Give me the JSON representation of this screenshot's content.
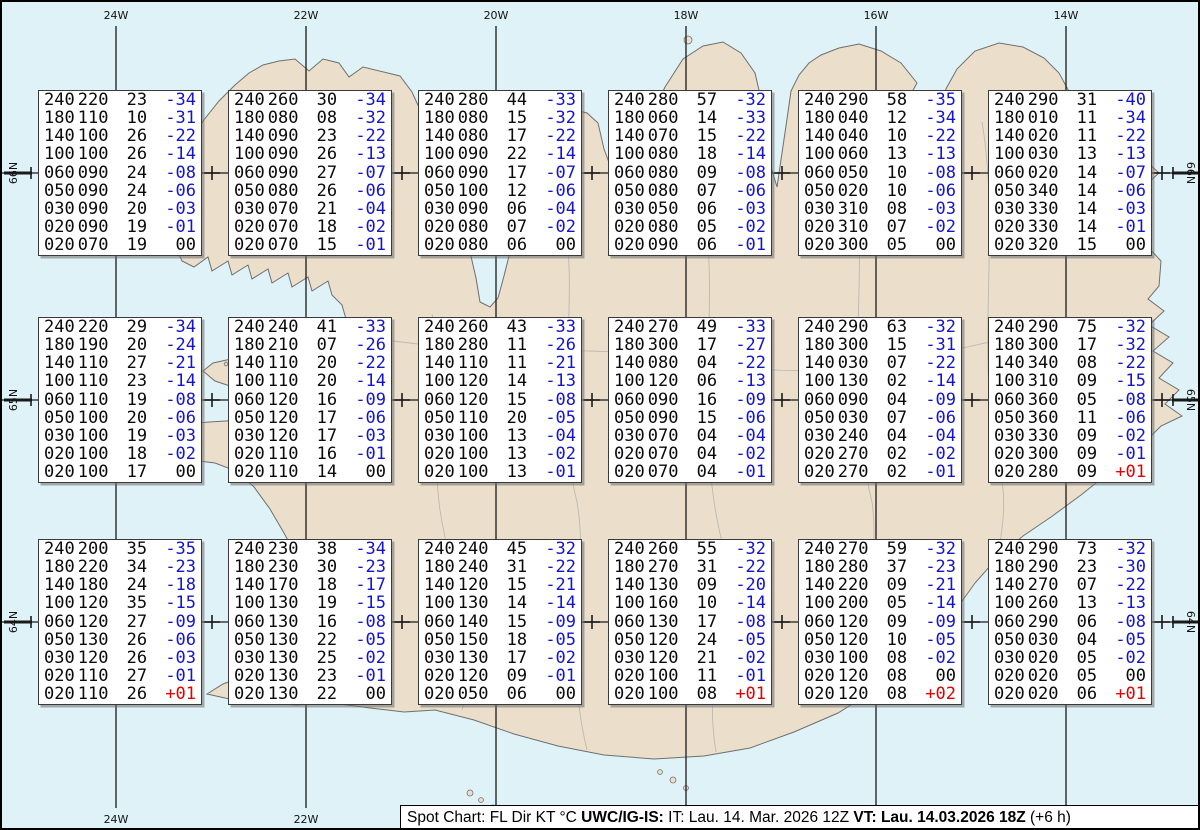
{
  "title": "Spot Chart Iceland upper-air spot values",
  "colors": {
    "ocean": "#dff2f8",
    "land": "#ebdfcc",
    "coast": "#6f6f6f",
    "interior_border": "#a8a8a8",
    "grid_line": "#1a1a1a",
    "negative_temp": "#1414cc",
    "positive_temp": "#e00000",
    "box_background": "#ffffff"
  },
  "grid": {
    "top_labels": [
      {
        "text": "24W",
        "x": 114
      },
      {
        "text": "22W",
        "x": 304
      },
      {
        "text": "20W",
        "x": 494
      },
      {
        "text": "18W",
        "x": 684
      },
      {
        "text": "16W",
        "x": 874
      },
      {
        "text": "14W",
        "x": 1064
      }
    ],
    "bottom_labels": [
      {
        "text": "24W",
        "x": 114
      },
      {
        "text": "22W",
        "x": 304
      }
    ],
    "left_labels": [
      {
        "text": "66N",
        "y": 171
      },
      {
        "text": "65N",
        "y": 398
      },
      {
        "text": "64N",
        "y": 620
      }
    ],
    "right_labels": [
      {
        "text": "66N",
        "y": 171
      },
      {
        "text": "65N",
        "y": 398
      },
      {
        "text": "64N",
        "y": 620
      }
    ],
    "meridians_x": [
      114,
      304,
      494,
      684,
      874,
      1064
    ],
    "parallels_y": [
      171,
      398,
      620
    ],
    "spot_marker_x": [
      210,
      400,
      590,
      780,
      970,
      1160
    ]
  },
  "chart_data": {
    "type": "table",
    "title": "Spot Chart: FL Dir KT °C",
    "columns": [
      "FL",
      "Dir",
      "KT",
      "°C"
    ],
    "lat_bands": [
      "66N",
      "65N",
      "64N"
    ],
    "spots": [
      {
        "row": 0,
        "col": 0,
        "rows": [
          [
            "240",
            "220",
            "23",
            "-34"
          ],
          [
            "180",
            "110",
            "10",
            "-31"
          ],
          [
            "140",
            "100",
            "26",
            "-22"
          ],
          [
            "100",
            "100",
            "26",
            "-14"
          ],
          [
            "060",
            "090",
            "24",
            "-08"
          ],
          [
            "050",
            "090",
            "24",
            "-06"
          ],
          [
            "030",
            "090",
            "20",
            "-03"
          ],
          [
            "020",
            "090",
            "19",
            "-01"
          ],
          [
            "020",
            "070",
            "19",
            "00"
          ]
        ]
      },
      {
        "row": 0,
        "col": 1,
        "rows": [
          [
            "240",
            "260",
            "30",
            "-34"
          ],
          [
            "180",
            "080",
            "08",
            "-32"
          ],
          [
            "140",
            "090",
            "23",
            "-22"
          ],
          [
            "100",
            "090",
            "26",
            "-13"
          ],
          [
            "060",
            "090",
            "27",
            "-07"
          ],
          [
            "050",
            "080",
            "26",
            "-06"
          ],
          [
            "030",
            "070",
            "21",
            "-04"
          ],
          [
            "020",
            "070",
            "18",
            "-02"
          ],
          [
            "020",
            "070",
            "15",
            "-01"
          ]
        ]
      },
      {
        "row": 0,
        "col": 2,
        "rows": [
          [
            "240",
            "280",
            "44",
            "-33"
          ],
          [
            "180",
            "080",
            "15",
            "-32"
          ],
          [
            "140",
            "080",
            "17",
            "-22"
          ],
          [
            "100",
            "090",
            "22",
            "-14"
          ],
          [
            "060",
            "090",
            "17",
            "-07"
          ],
          [
            "050",
            "100",
            "12",
            "-06"
          ],
          [
            "030",
            "090",
            "06",
            "-04"
          ],
          [
            "020",
            "080",
            "07",
            "-02"
          ],
          [
            "020",
            "080",
            "06",
            "00"
          ]
        ]
      },
      {
        "row": 0,
        "col": 3,
        "rows": [
          [
            "240",
            "280",
            "57",
            "-32"
          ],
          [
            "180",
            "060",
            "14",
            "-33"
          ],
          [
            "140",
            "070",
            "15",
            "-22"
          ],
          [
            "100",
            "080",
            "18",
            "-14"
          ],
          [
            "060",
            "080",
            "09",
            "-08"
          ],
          [
            "050",
            "080",
            "07",
            "-06"
          ],
          [
            "030",
            "050",
            "06",
            "-03"
          ],
          [
            "020",
            "080",
            "05",
            "-02"
          ],
          [
            "020",
            "090",
            "06",
            "-01"
          ]
        ]
      },
      {
        "row": 0,
        "col": 4,
        "rows": [
          [
            "240",
            "290",
            "58",
            "-35"
          ],
          [
            "180",
            "040",
            "12",
            "-34"
          ],
          [
            "140",
            "040",
            "10",
            "-22"
          ],
          [
            "100",
            "060",
            "13",
            "-13"
          ],
          [
            "060",
            "050",
            "10",
            "-08"
          ],
          [
            "050",
            "020",
            "10",
            "-06"
          ],
          [
            "030",
            "310",
            "08",
            "-03"
          ],
          [
            "020",
            "310",
            "07",
            "-02"
          ],
          [
            "020",
            "300",
            "05",
            "00"
          ]
        ]
      },
      {
        "row": 0,
        "col": 5,
        "rows": [
          [
            "240",
            "290",
            "31",
            "-40"
          ],
          [
            "180",
            "010",
            "11",
            "-34"
          ],
          [
            "140",
            "020",
            "11",
            "-22"
          ],
          [
            "100",
            "030",
            "13",
            "-13"
          ],
          [
            "060",
            "020",
            "14",
            "-07"
          ],
          [
            "050",
            "340",
            "14",
            "-06"
          ],
          [
            "030",
            "330",
            "14",
            "-03"
          ],
          [
            "020",
            "330",
            "14",
            "-01"
          ],
          [
            "020",
            "320",
            "15",
            "00"
          ]
        ]
      },
      {
        "row": 1,
        "col": 0,
        "rows": [
          [
            "240",
            "220",
            "29",
            "-34"
          ],
          [
            "180",
            "190",
            "20",
            "-24"
          ],
          [
            "140",
            "110",
            "27",
            "-21"
          ],
          [
            "100",
            "110",
            "23",
            "-14"
          ],
          [
            "060",
            "110",
            "19",
            "-08"
          ],
          [
            "050",
            "100",
            "20",
            "-06"
          ],
          [
            "030",
            "100",
            "19",
            "-03"
          ],
          [
            "020",
            "100",
            "18",
            "-02"
          ],
          [
            "020",
            "100",
            "17",
            "00"
          ]
        ]
      },
      {
        "row": 1,
        "col": 1,
        "rows": [
          [
            "240",
            "240",
            "41",
            "-33"
          ],
          [
            "180",
            "210",
            "07",
            "-26"
          ],
          [
            "140",
            "110",
            "20",
            "-22"
          ],
          [
            "100",
            "110",
            "20",
            "-14"
          ],
          [
            "060",
            "120",
            "16",
            "-09"
          ],
          [
            "050",
            "120",
            "17",
            "-06"
          ],
          [
            "030",
            "120",
            "17",
            "-03"
          ],
          [
            "020",
            "110",
            "16",
            "-01"
          ],
          [
            "020",
            "110",
            "14",
            "00"
          ]
        ]
      },
      {
        "row": 1,
        "col": 2,
        "rows": [
          [
            "240",
            "260",
            "43",
            "-33"
          ],
          [
            "180",
            "280",
            "11",
            "-26"
          ],
          [
            "140",
            "110",
            "11",
            "-21"
          ],
          [
            "100",
            "120",
            "14",
            "-13"
          ],
          [
            "060",
            "120",
            "15",
            "-08"
          ],
          [
            "050",
            "110",
            "20",
            "-05"
          ],
          [
            "030",
            "100",
            "13",
            "-04"
          ],
          [
            "020",
            "100",
            "13",
            "-02"
          ],
          [
            "020",
            "100",
            "13",
            "-01"
          ]
        ]
      },
      {
        "row": 1,
        "col": 3,
        "rows": [
          [
            "240",
            "270",
            "49",
            "-33"
          ],
          [
            "180",
            "300",
            "17",
            "-27"
          ],
          [
            "140",
            "080",
            "04",
            "-22"
          ],
          [
            "100",
            "120",
            "06",
            "-13"
          ],
          [
            "060",
            "090",
            "16",
            "-09"
          ],
          [
            "050",
            "090",
            "15",
            "-06"
          ],
          [
            "030",
            "070",
            "04",
            "-04"
          ],
          [
            "020",
            "070",
            "04",
            "-02"
          ],
          [
            "020",
            "070",
            "04",
            "-01"
          ]
        ]
      },
      {
        "row": 1,
        "col": 4,
        "rows": [
          [
            "240",
            "290",
            "63",
            "-32"
          ],
          [
            "180",
            "300",
            "15",
            "-31"
          ],
          [
            "140",
            "030",
            "07",
            "-22"
          ],
          [
            "100",
            "130",
            "02",
            "-14"
          ],
          [
            "060",
            "090",
            "04",
            "-09"
          ],
          [
            "050",
            "030",
            "07",
            "-06"
          ],
          [
            "030",
            "240",
            "04",
            "-04"
          ],
          [
            "020",
            "270",
            "02",
            "-02"
          ],
          [
            "020",
            "270",
            "02",
            "-01"
          ]
        ]
      },
      {
        "row": 1,
        "col": 5,
        "rows": [
          [
            "240",
            "290",
            "75",
            "-32"
          ],
          [
            "180",
            "300",
            "17",
            "-32"
          ],
          [
            "140",
            "340",
            "08",
            "-22"
          ],
          [
            "100",
            "310",
            "09",
            "-15"
          ],
          [
            "060",
            "360",
            "05",
            "-08"
          ],
          [
            "050",
            "360",
            "11",
            "-06"
          ],
          [
            "030",
            "330",
            "09",
            "-02"
          ],
          [
            "020",
            "300",
            "09",
            "-01"
          ],
          [
            "020",
            "280",
            "09",
            "+01"
          ]
        ]
      },
      {
        "row": 2,
        "col": 0,
        "rows": [
          [
            "240",
            "200",
            "35",
            "-35"
          ],
          [
            "180",
            "220",
            "34",
            "-23"
          ],
          [
            "140",
            "180",
            "24",
            "-18"
          ],
          [
            "100",
            "120",
            "35",
            "-15"
          ],
          [
            "060",
            "120",
            "27",
            "-09"
          ],
          [
            "050",
            "130",
            "26",
            "-06"
          ],
          [
            "030",
            "120",
            "26",
            "-03"
          ],
          [
            "020",
            "110",
            "27",
            "-01"
          ],
          [
            "020",
            "110",
            "26",
            "+01"
          ]
        ]
      },
      {
        "row": 2,
        "col": 1,
        "rows": [
          [
            "240",
            "230",
            "38",
            "-34"
          ],
          [
            "180",
            "230",
            "30",
            "-23"
          ],
          [
            "140",
            "170",
            "18",
            "-17"
          ],
          [
            "100",
            "130",
            "19",
            "-15"
          ],
          [
            "060",
            "130",
            "16",
            "-08"
          ],
          [
            "050",
            "130",
            "22",
            "-05"
          ],
          [
            "030",
            "130",
            "25",
            "-02"
          ],
          [
            "020",
            "130",
            "23",
            "-01"
          ],
          [
            "020",
            "130",
            "22",
            "00"
          ]
        ]
      },
      {
        "row": 2,
        "col": 2,
        "rows": [
          [
            "240",
            "240",
            "45",
            "-32"
          ],
          [
            "180",
            "240",
            "31",
            "-22"
          ],
          [
            "140",
            "120",
            "15",
            "-21"
          ],
          [
            "100",
            "130",
            "14",
            "-14"
          ],
          [
            "060",
            "140",
            "15",
            "-09"
          ],
          [
            "050",
            "150",
            "18",
            "-05"
          ],
          [
            "030",
            "130",
            "17",
            "-02"
          ],
          [
            "020",
            "120",
            "09",
            "-01"
          ],
          [
            "020",
            "050",
            "06",
            "00"
          ]
        ]
      },
      {
        "row": 2,
        "col": 3,
        "rows": [
          [
            "240",
            "260",
            "55",
            "-32"
          ],
          [
            "180",
            "270",
            "31",
            "-22"
          ],
          [
            "140",
            "130",
            "09",
            "-20"
          ],
          [
            "100",
            "160",
            "10",
            "-14"
          ],
          [
            "060",
            "130",
            "17",
            "-08"
          ],
          [
            "050",
            "120",
            "24",
            "-05"
          ],
          [
            "030",
            "120",
            "21",
            "-02"
          ],
          [
            "020",
            "100",
            "11",
            "-01"
          ],
          [
            "020",
            "100",
            "08",
            "+01"
          ]
        ]
      },
      {
        "row": 2,
        "col": 4,
        "rows": [
          [
            "240",
            "270",
            "59",
            "-32"
          ],
          [
            "180",
            "280",
            "37",
            "-23"
          ],
          [
            "140",
            "220",
            "09",
            "-21"
          ],
          [
            "100",
            "200",
            "05",
            "-14"
          ],
          [
            "060",
            "120",
            "09",
            "-09"
          ],
          [
            "050",
            "120",
            "10",
            "-05"
          ],
          [
            "030",
            "100",
            "08",
            "-02"
          ],
          [
            "020",
            "120",
            "08",
            "00"
          ],
          [
            "020",
            "120",
            "08",
            "+02"
          ]
        ]
      },
      {
        "row": 2,
        "col": 5,
        "rows": [
          [
            "240",
            "290",
            "73",
            "-32"
          ],
          [
            "180",
            "290",
            "23",
            "-30"
          ],
          [
            "140",
            "270",
            "07",
            "-22"
          ],
          [
            "100",
            "260",
            "13",
            "-13"
          ],
          [
            "060",
            "290",
            "06",
            "-08"
          ],
          [
            "050",
            "030",
            "04",
            "-05"
          ],
          [
            "030",
            "020",
            "05",
            "-02"
          ],
          [
            "020",
            "020",
            "05",
            "00"
          ],
          [
            "020",
            "020",
            "06",
            "+01"
          ]
        ]
      }
    ]
  },
  "caption": {
    "segments": [
      {
        "text": "Spot Chart: FL Dir KT °C ",
        "bold": false
      },
      {
        "text": "UWC/IG-IS:",
        "bold": true
      },
      {
        "text": " IT: Lau. 14. Mar. 2026 12Z ",
        "bold": false
      },
      {
        "text": "VT: Lau. 14.03.2026 18Z",
        "bold": true
      },
      {
        "text": " (+6 h)",
        "bold": false
      }
    ]
  }
}
